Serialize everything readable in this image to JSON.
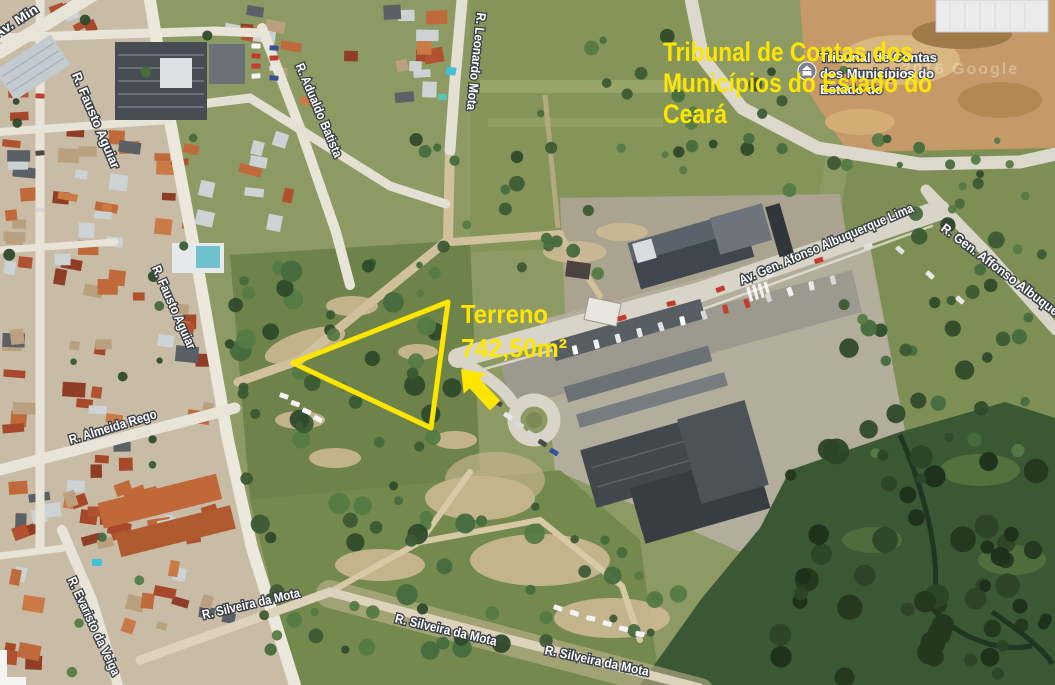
{
  "annotations": {
    "highlight_color": "#ffe600",
    "title_lines": [
      "Tribunal de Contas dos",
      "Municípios do Estado do",
      "Ceará"
    ],
    "terreno_label": "Terreno",
    "terreno_area": "742,50m²"
  },
  "map_labels": {
    "streets": [
      {
        "text": "Av. Min",
        "x": 18,
        "y": 25,
        "rot": -33,
        "len": 50
      },
      {
        "text": "R. Fausto Aguiar",
        "x": 92,
        "y": 122,
        "rot": 67,
        "len": 103
      },
      {
        "text": "R. Adualdo Batista",
        "x": 315,
        "y": 112,
        "rot": 67,
        "len": 101
      },
      {
        "text": "R. Leonardo Mota",
        "x": 472,
        "y": 61,
        "rot": 96,
        "len": 98
      },
      {
        "text": "R. Fausto Aguiar",
        "x": 170,
        "y": 309,
        "rot": 66,
        "len": 90
      },
      {
        "text": "R. Almeida Rego",
        "x": 114,
        "y": 431,
        "rot": -17,
        "len": 91
      },
      {
        "text": "R. Evaristo da Veiga",
        "x": 90,
        "y": 628,
        "rot": 65,
        "len": 107
      },
      {
        "text": "Av. Gen. Afonso Albuquerque Lima",
        "x": 828,
        "y": 248,
        "rot": -23,
        "len": 188
      },
      {
        "text": "R. Gen. Affonso Albuquerque",
        "x": 1008,
        "y": 281,
        "rot": 37,
        "len": 170
      },
      {
        "text": "R. Silveira da Mota",
        "x": 252,
        "y": 608,
        "rot": -13,
        "len": 100
      },
      {
        "text": "R. Silveira da Mota",
        "x": 445,
        "y": 634,
        "rot": 13,
        "len": 104
      },
      {
        "text": "R. Silveira da Mota",
        "x": 596,
        "y": 665,
        "rot": 12,
        "len": 106
      }
    ],
    "poi": {
      "icon": "government-building-icon",
      "lines": [
        "Tribunal de Contas",
        "dos Municípios do",
        "Estado do"
      ],
      "x": 820,
      "y": 62,
      "icon_x": 807,
      "icon_y": 71
    },
    "watermark": "2016 Google"
  }
}
